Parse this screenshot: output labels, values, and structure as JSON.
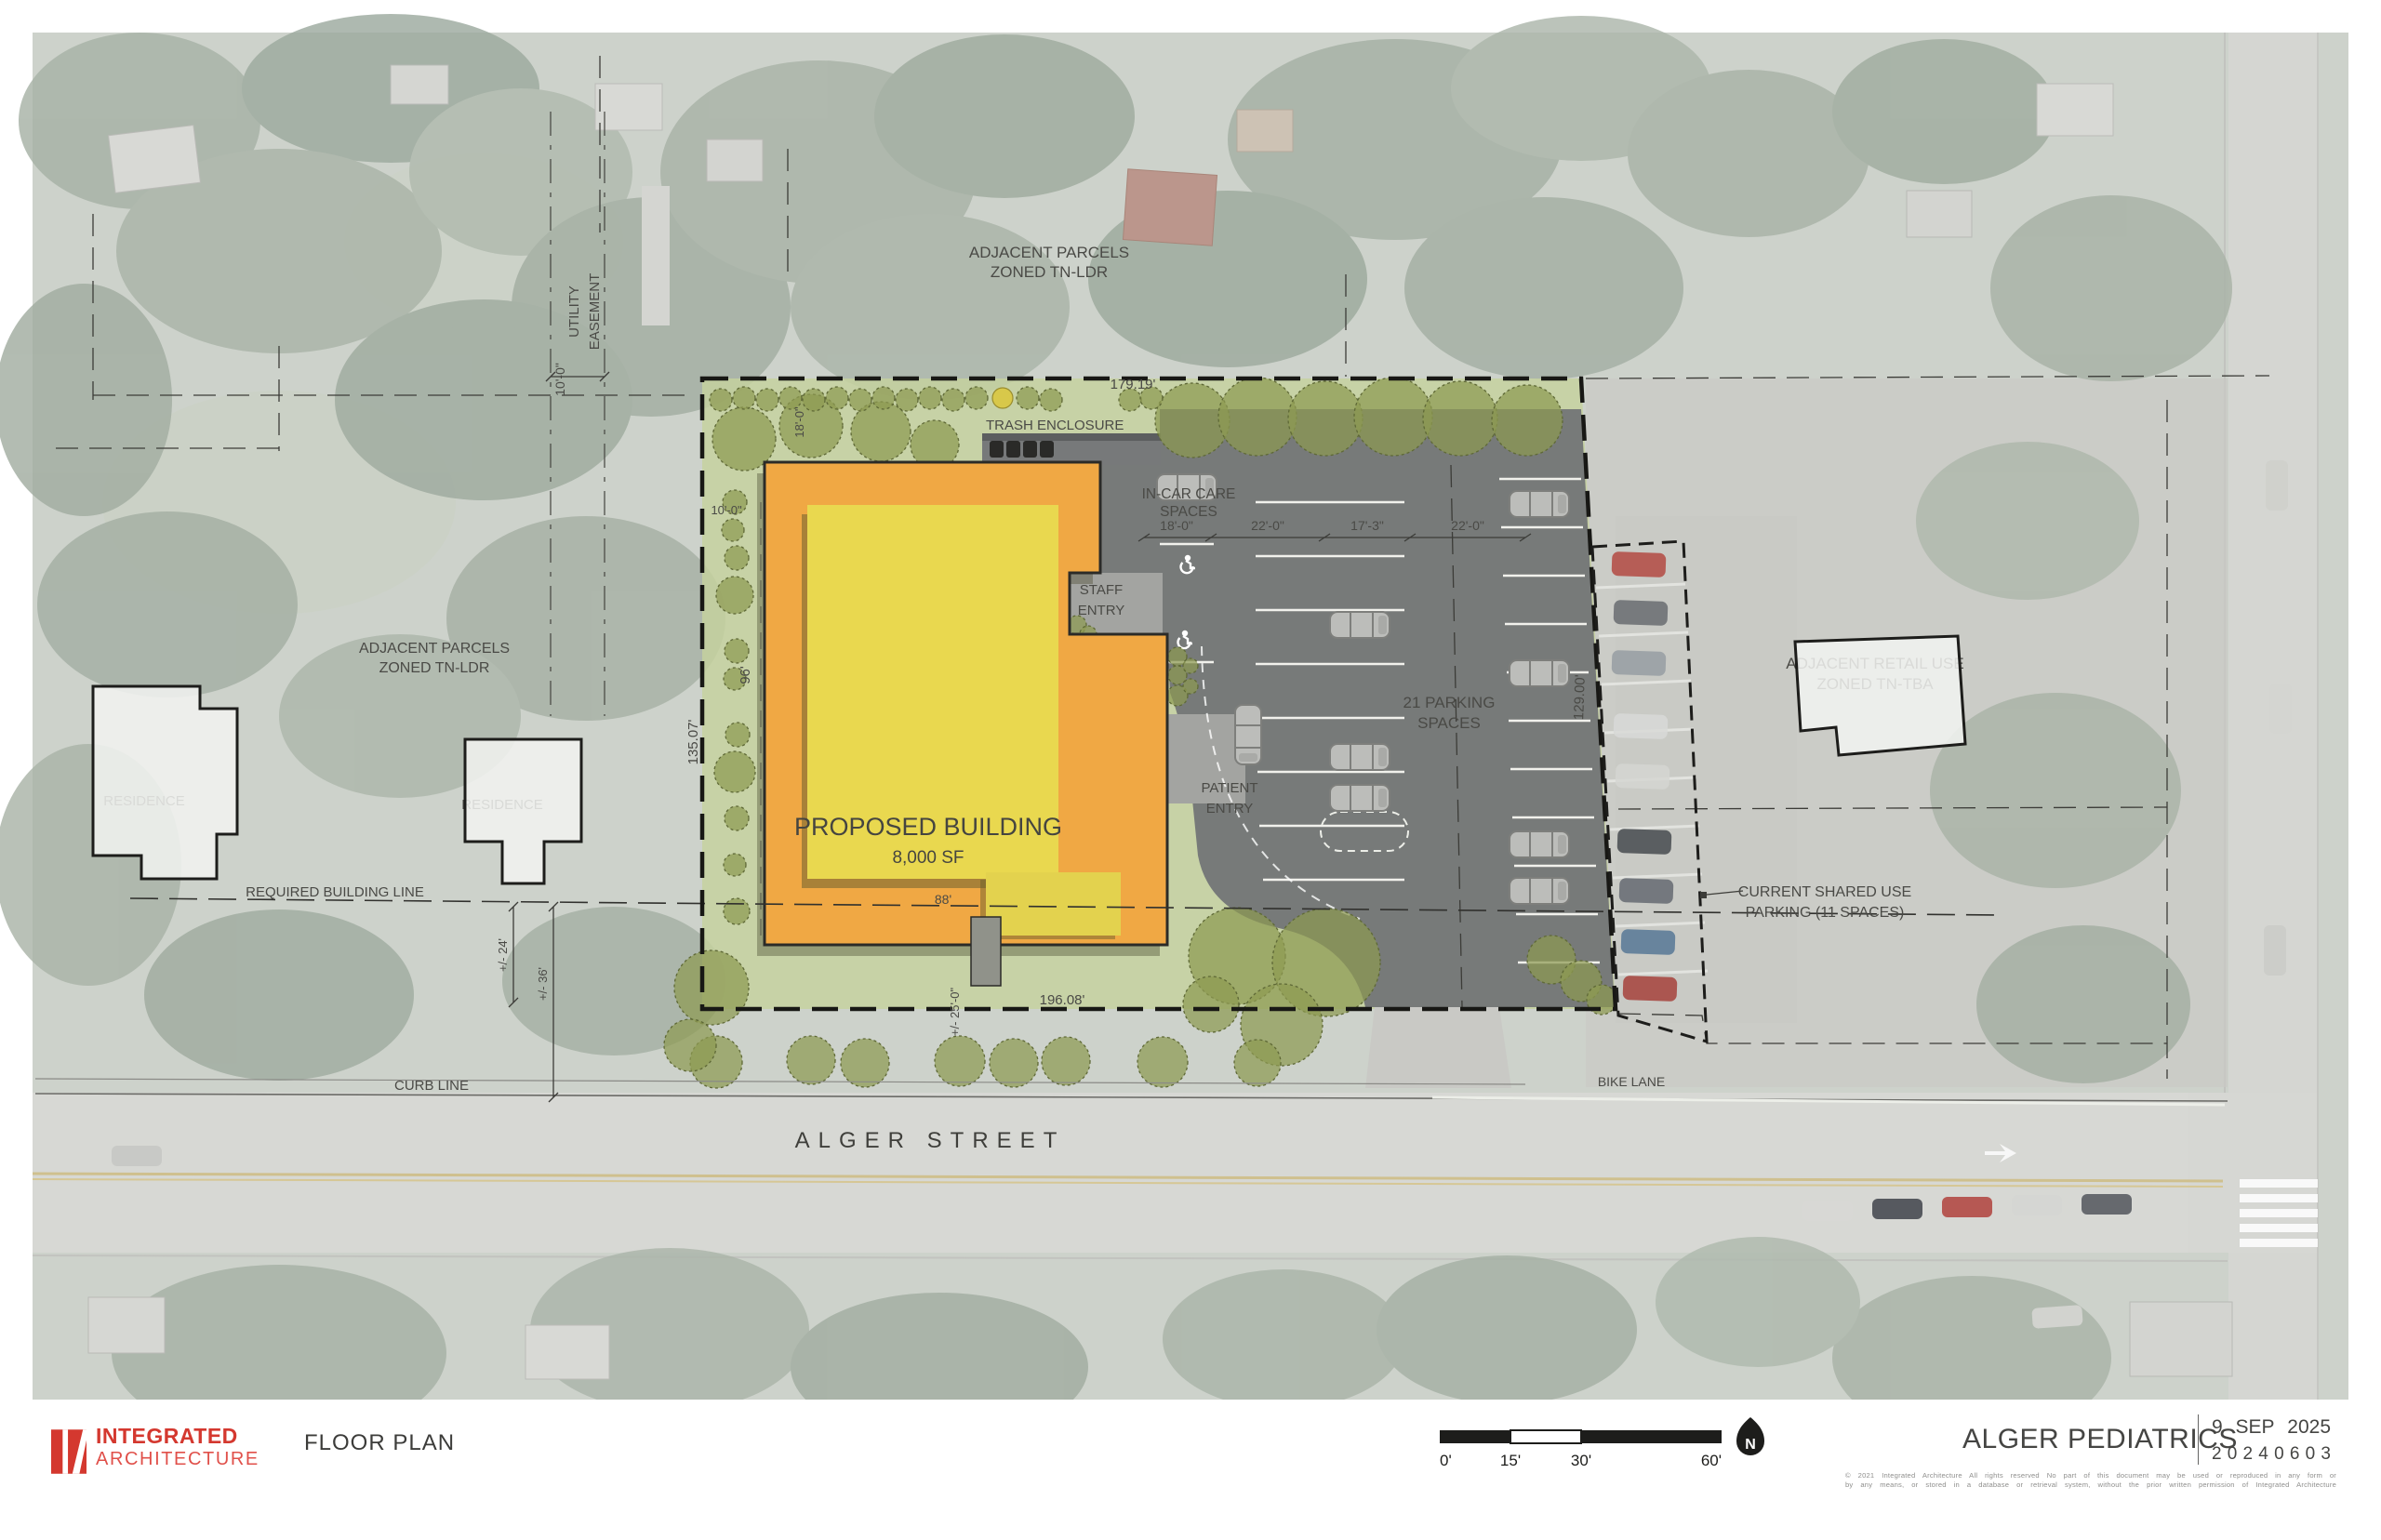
{
  "plan": {
    "street_name": "ALGER STREET",
    "labels": {
      "adjacent_parcels_top_1": "ADJACENT PARCELS",
      "adjacent_parcels_top_2": "ZONED TN-LDR",
      "adjacent_parcels_left_1": "ADJACENT PARCELS",
      "adjacent_parcels_left_2": "ZONED TN-LDR",
      "utility_easement_1": "UTILITY",
      "utility_easement_2": "EASEMENT",
      "trash_enclosure": "TRASH ENCLOSURE",
      "in_car_care_1": "IN-CAR CARE",
      "in_car_care_2": "SPACES",
      "staff_entry_1": "STAFF",
      "staff_entry_2": "ENTRY",
      "patient_entry_1": "PATIENT",
      "patient_entry_2": "ENTRY",
      "parking_1": "21 PARKING",
      "parking_2": "SPACES",
      "proposed_building": "PROPOSED BUILDING",
      "building_area": "8,000 SF",
      "residence_left": "RESIDENCE",
      "residence_mid": "RESIDENCE",
      "adjacent_retail_1": "ADJACENT RETAIL USE",
      "adjacent_retail_2": "ZONED TN-TBA",
      "shared_parking_1": "CURRENT SHARED USE",
      "shared_parking_2": "PARKING (11 SPACES)",
      "required_building_line": "REQUIRED BUILDING LINE",
      "curb_line": "CURB LINE",
      "bike_lane": "BIKE LANE"
    },
    "dimensions": {
      "easement_width": "10'-0\"",
      "top_boundary": "179.19'",
      "left_boundary": "135.07'",
      "right_boundary": "129.00'",
      "bottom_boundary": "196.08'",
      "building_depth": "96'",
      "building_width": "88'",
      "side_setback": "10'-0\"",
      "tree_spacing": "18'-0\"",
      "stall_dim_1": "18'-0\"",
      "stall_dim_2": "22'-0\"",
      "stall_dim_3": "17'-3\"",
      "stall_dim_4": "22'-0\"",
      "setback_24": "+/- 24'",
      "setback_36": "+/- 36'",
      "street_width": "+/- 25'-0\""
    }
  },
  "title_bar": {
    "logo_line1": "INTEGRATED",
    "logo_line2": "ARCHITECTURE",
    "sheet_title": "FLOOR PLAN",
    "scale": {
      "t0": "0'",
      "t15": "15'",
      "t30": "30'",
      "t60": "60'"
    },
    "north_label": "N",
    "project_name": "ALGER PEDIATRICS",
    "date_d": "9",
    "date_m": "SEP",
    "date_y": "2025",
    "project_number": [
      "2",
      "0",
      "2",
      "4",
      "0",
      "6",
      "0",
      "3"
    ],
    "project_number_text": "20240603",
    "copyright_1": "© 2021 Integrated Architecture   All rights reserved   No part of this document may be used or reproduced in any form or",
    "copyright_2": "by any means, or stored in a database or retrieval system, without the prior written permission of Integrated Architecture"
  }
}
